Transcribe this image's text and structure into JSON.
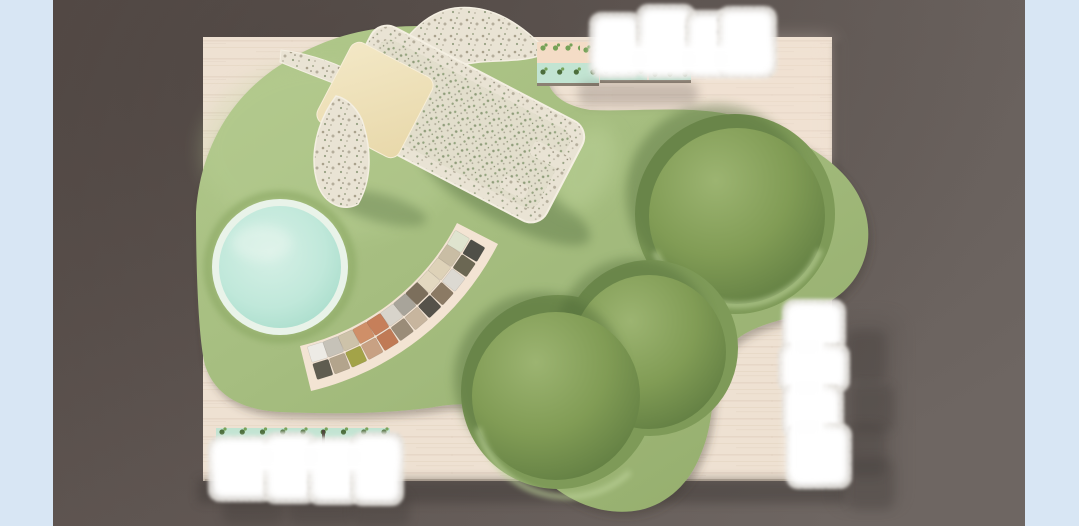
{
  "canvas": {
    "width": 1079,
    "height": 526
  },
  "scene": {
    "type": "3d-architectural-render-top-view",
    "elements": [
      "side-panel-left",
      "side-panel-right",
      "gallery-floor",
      "wood-platform",
      "green-carpet",
      "ball-pool",
      "banana-play-structure",
      "material-swatch-fan",
      "seating-dome-large",
      "seating-dome-pair",
      "planter-shelf-top",
      "planter-shelf-bottom",
      "glow-bench-cluster-top-right",
      "glow-bench-cluster-bottom-left",
      "glow-bench-cluster-right"
    ],
    "palette": {
      "side_panel": "#d8e6f4",
      "floor_a": "#594f4b",
      "floor_b": "#6e6662",
      "shadow": "#3e3734",
      "wood": "#eee1d2",
      "wood_grain": "#e0d0bd",
      "wood_blush": "#f6e3d5",
      "platform_edge": "#8a7f72",
      "carpet_a": "#b2c98c",
      "carpet_b": "#a5bd7f",
      "carpet_c": "#94ad6c",
      "carpet_light": "#bdd39a",
      "recess": "#7e9a58",
      "recess_shadow": "#4c6636",
      "dome_hi": "#9cb471",
      "dome_mid": "#819c55",
      "dome_lo": "#5a773e",
      "pool_rim": "#e9f3e9",
      "pool_a": "#d6f0e6",
      "pool_b": "#c0e8da",
      "pool_c": "#a5dbc9",
      "pool_ring": "#8fab68",
      "terrazzo_base": "#e9e3d4",
      "trough_base": "#e2decc",
      "mat_a": "#f3e8c6",
      "mat_b": "#e8d8aa",
      "glow_white": "#ffffff",
      "speck_base": "#e6e3de",
      "speck_dot": "#aeaba5",
      "planter_mint": "#c2e4d2",
      "planter_peach": "#f4dcc6",
      "planter_base": "#8b8072",
      "plant_green": "#76a258",
      "plant_dark": "#4c6e3c"
    },
    "swatch_arc": {
      "rows": 2,
      "columns": 12,
      "backing": "#f3e4d3",
      "outer_colors": [
        "#5f5c50",
        "#b3a48c",
        "#a3a348",
        "#c8a183",
        "#c07a55",
        "#9a8c78",
        "#c7b59e",
        "#55524a",
        "#8b7a64",
        "#dcd9d2",
        "#6b6753",
        "#4f4f48"
      ],
      "inner_colors": [
        "#edebe5",
        "#c6c2b8",
        "#cdc2a9",
        "#cf8f68",
        "#c67f5a",
        "#d8d4cb",
        "#a8a49a",
        "#7c6f5c",
        "#e3d8c0",
        "#ded2b8",
        "#c9bda4",
        "#dfe4cf"
      ]
    },
    "glow_clusters": {
      "top_right_blocks": 4,
      "bottom_left_blocks": 4,
      "right_blocks": 4
    }
  }
}
